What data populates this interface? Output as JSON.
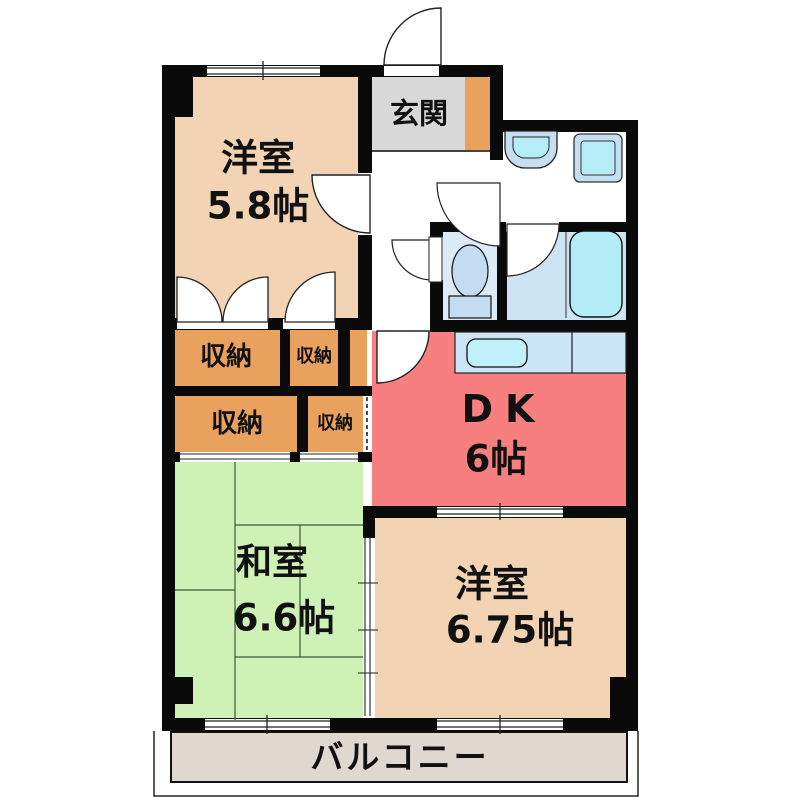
{
  "plan_title": "2DK apartment floor plan",
  "labels": {
    "western1_name": "洋室",
    "western1_size": "5.8帖",
    "entrance": "玄関",
    "closet_big1": "収納",
    "closet_small1": "収納",
    "closet_big2": "収納",
    "closet_small2": "収納",
    "dk_name": "DK",
    "dk_size": "6帖",
    "japanese_name": "和室",
    "japanese_size": "6.6帖",
    "western2_name": "洋室",
    "western2_size": "6.75帖",
    "balcony": "バルコニー"
  },
  "fixtures": [
    "washbasin",
    "washing-machine-pan",
    "toilet",
    "bathtub",
    "kitchen-sink-counter"
  ],
  "colors": {
    "wall": "#0a0a0a",
    "western_room": "#F2D3B4",
    "entrance_floor": "#D8D8D8",
    "storage_orange": "#E9A25E",
    "dk_pink": "#F77F7F",
    "japanese_green": "#CEF2B6",
    "toilet_room": "#DCEAF8",
    "bath_room": "#CCE3F4",
    "bathtub": "#B3EBF7",
    "counter": "#C9E5F7",
    "sink": "#BFF0FB",
    "fixture_blue": "#C5DFF0",
    "balcony": "#DFD8CE"
  }
}
